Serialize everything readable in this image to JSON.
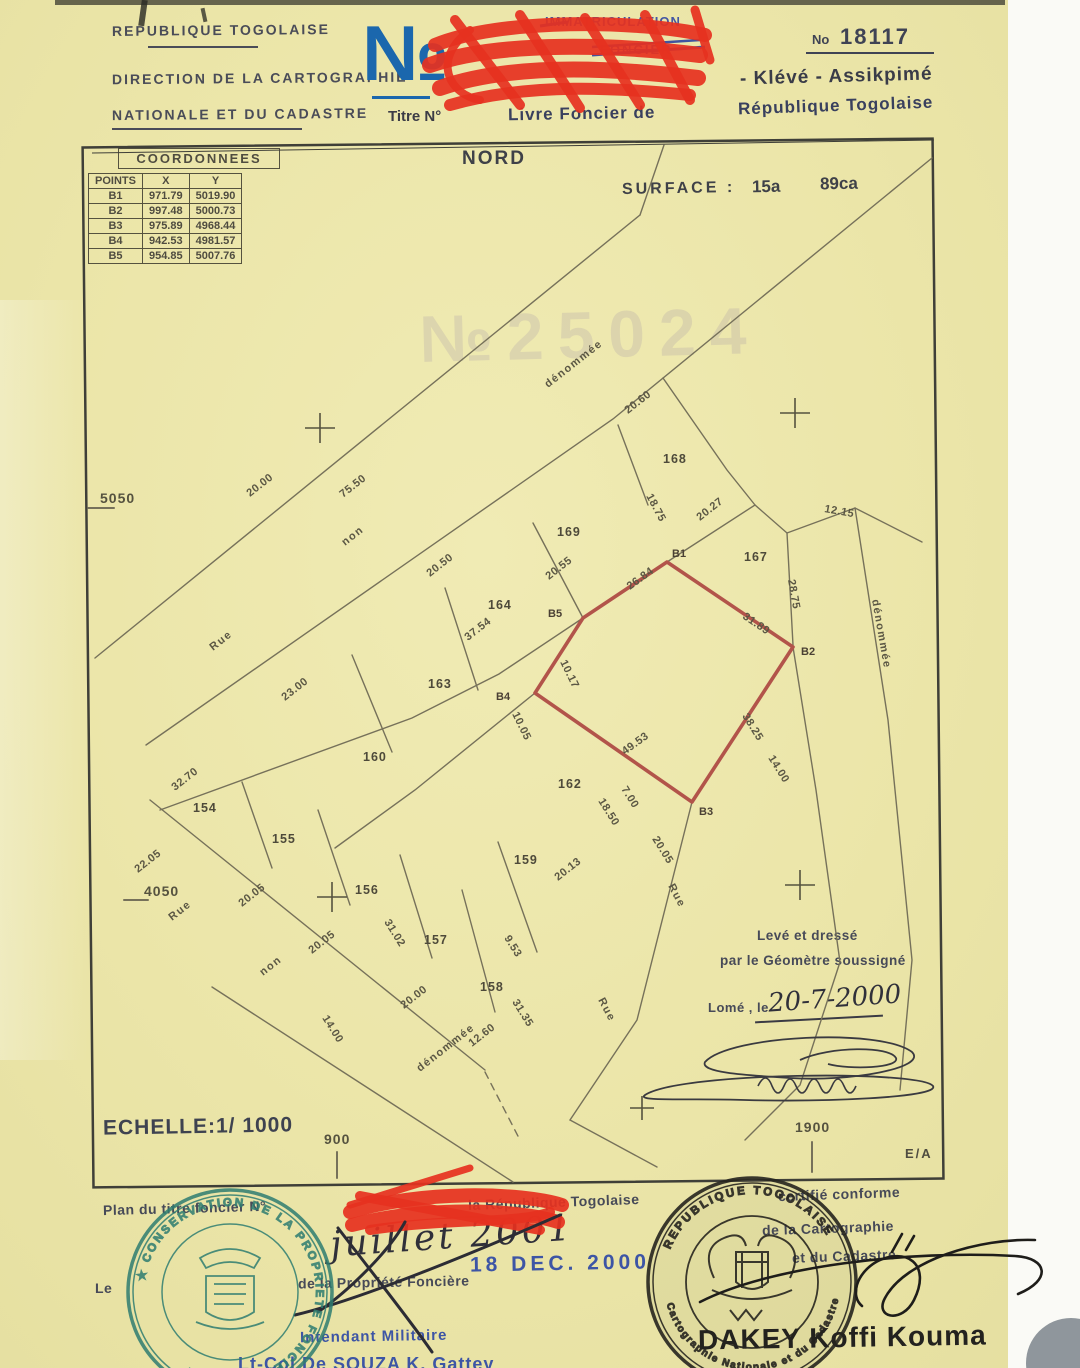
{
  "colors": {
    "paper": "#ece7ac",
    "map_line": "#6e6953",
    "parcel_red": "#b2544a",
    "scribble_red": "#e63120",
    "big_no_blue": "#1b67ad",
    "stamp_blue": "#4457a3",
    "stamp_teal": "#2f7d71",
    "stamp_black": "#23221f"
  },
  "header": {
    "country": "REPUBLIQUE TOGOLAISE",
    "dept1": "DIRECTION DE LA CARTOGRAPHIE",
    "dept2": "NATIONALE ET DU CADASTRE",
    "big_no": "№",
    "titre": "Titre N°",
    "immatriculation": "IMMATRICULATION",
    "foncier": "FONCIER",
    "reg_label": "No",
    "reg_number": "18117",
    "locality": "- Klévé - Assikpimé",
    "livre_left": "Livre Foncier de",
    "livre_right": "République Togolaise"
  },
  "table": {
    "title": "COORDONNEES",
    "columns": [
      "POINTS",
      "X",
      "Y"
    ],
    "rows": [
      [
        "B1",
        "971.79",
        "5019.90"
      ],
      [
        "B2",
        "997.48",
        "5000.73"
      ],
      [
        "B3",
        "975.89",
        "4968.44"
      ],
      [
        "B4",
        "942.53",
        "4981.57"
      ],
      [
        "B5",
        "954.85",
        "5007.76"
      ]
    ]
  },
  "map": {
    "north": "NORD",
    "surface_label": "SURFACE :",
    "surface_value_a": "15a",
    "surface_value_ca": "89ca",
    "watermark": "№25024",
    "scale": "ECHELLE:1/ 1000",
    "ea": "E/A",
    "grid_marks": [
      {
        "t": "5050",
        "x": 100,
        "y": 503
      },
      {
        "t": "4050",
        "x": 144,
        "y": 896
      }
    ],
    "axis_ticks": [
      {
        "t": "900",
        "x": 324,
        "y": 1144
      },
      {
        "t": "1900",
        "x": 795,
        "y": 1132
      }
    ],
    "parcels": [
      {
        "n": "154",
        "x": 193,
        "y": 812
      },
      {
        "n": "155",
        "x": 272,
        "y": 843
      },
      {
        "n": "156",
        "x": 355,
        "y": 894
      },
      {
        "n": "157",
        "x": 424,
        "y": 944
      },
      {
        "n": "158",
        "x": 480,
        "y": 991
      },
      {
        "n": "159",
        "x": 514,
        "y": 864
      },
      {
        "n": "160",
        "x": 363,
        "y": 761
      },
      {
        "n": "162",
        "x": 558,
        "y": 788
      },
      {
        "n": "163",
        "x": 428,
        "y": 688
      },
      {
        "n": "164",
        "x": 488,
        "y": 609
      },
      {
        "n": "167",
        "x": 744,
        "y": 561
      },
      {
        "n": "168",
        "x": 663,
        "y": 463
      },
      {
        "n": "169",
        "x": 557,
        "y": 536
      }
    ],
    "vertices": [
      {
        "n": "B1",
        "x": 672,
        "y": 557
      },
      {
        "n": "B2",
        "x": 801,
        "y": 655
      },
      {
        "n": "B3",
        "x": 699,
        "y": 815
      },
      {
        "n": "B4",
        "x": 496,
        "y": 700
      },
      {
        "n": "B5",
        "x": 548,
        "y": 617
      }
    ],
    "measurements": [
      {
        "t": "20.00",
        "x": 250,
        "y": 497,
        "r": -38
      },
      {
        "t": "75.50",
        "x": 343,
        "y": 498,
        "r": -38
      },
      {
        "t": "20.50",
        "x": 430,
        "y": 577,
        "r": -38
      },
      {
        "t": "20.55",
        "x": 549,
        "y": 580,
        "r": -38
      },
      {
        "t": "26.84",
        "x": 630,
        "y": 590,
        "r": -36
      },
      {
        "t": "31.89",
        "x": 742,
        "y": 618,
        "r": 34
      },
      {
        "t": "20.27",
        "x": 700,
        "y": 521,
        "r": -38
      },
      {
        "t": "18.75",
        "x": 646,
        "y": 496,
        "r": 62
      },
      {
        "t": "20.60",
        "x": 628,
        "y": 414,
        "r": -38
      },
      {
        "t": "12.15",
        "x": 824,
        "y": 512,
        "r": 10
      },
      {
        "t": "28.75",
        "x": 788,
        "y": 580,
        "r": 80
      },
      {
        "t": "38.25",
        "x": 742,
        "y": 716,
        "r": 58
      },
      {
        "t": "14.00",
        "x": 768,
        "y": 758,
        "r": 58
      },
      {
        "t": "49.53",
        "x": 625,
        "y": 755,
        "r": -36
      },
      {
        "t": "10.17",
        "x": 560,
        "y": 662,
        "r": 64
      },
      {
        "t": "10.05",
        "x": 512,
        "y": 714,
        "r": 64
      },
      {
        "t": "37.54",
        "x": 468,
        "y": 641,
        "r": -38
      },
      {
        "t": "23.00",
        "x": 285,
        "y": 701,
        "r": -38
      },
      {
        "t": "32.70",
        "x": 175,
        "y": 791,
        "r": -38
      },
      {
        "t": "22.05",
        "x": 138,
        "y": 873,
        "r": -38
      },
      {
        "t": "20.05",
        "x": 242,
        "y": 907,
        "r": -38
      },
      {
        "t": "20.05",
        "x": 312,
        "y": 954,
        "r": -38
      },
      {
        "t": "31.02",
        "x": 384,
        "y": 922,
        "r": 58
      },
      {
        "t": "20.00",
        "x": 404,
        "y": 1009,
        "r": -38
      },
      {
        "t": "14.00",
        "x": 322,
        "y": 1018,
        "r": 58
      },
      {
        "t": "12.60",
        "x": 472,
        "y": 1047,
        "r": -38
      },
      {
        "t": "31.35",
        "x": 512,
        "y": 1002,
        "r": 58
      },
      {
        "t": "9.53",
        "x": 504,
        "y": 938,
        "r": 58
      },
      {
        "t": "20.13",
        "x": 558,
        "y": 881,
        "r": -38
      },
      {
        "t": "18.50",
        "x": 598,
        "y": 801,
        "r": 58
      },
      {
        "t": "7.00",
        "x": 621,
        "y": 789,
        "r": 58
      },
      {
        "t": "20.05",
        "x": 652,
        "y": 839,
        "r": 58
      }
    ],
    "streets": [
      {
        "t": "Rue",
        "x": 213,
        "y": 651,
        "r": -38
      },
      {
        "t": "non",
        "x": 345,
        "y": 546,
        "r": -38
      },
      {
        "t": "dénommée",
        "x": 548,
        "y": 388,
        "r": -38
      },
      {
        "t": "Rue",
        "x": 172,
        "y": 921,
        "r": -38
      },
      {
        "t": "non",
        "x": 263,
        "y": 976,
        "r": -38
      },
      {
        "t": "dénommée",
        "x": 420,
        "y": 1072,
        "r": -38
      },
      {
        "t": "Rue",
        "x": 668,
        "y": 886,
        "r": 62
      },
      {
        "t": "dénommée",
        "x": 872,
        "y": 600,
        "r": 80
      },
      {
        "t": "Rue",
        "x": 598,
        "y": 1000,
        "r": 62
      }
    ]
  },
  "surveyor": {
    "line1": "Levé et dressé",
    "line2": "par le Géomètre soussigné",
    "place": "Lomé , le",
    "date": "20-7-2000"
  },
  "certification": {
    "plan_left": "Plan du titre foncier N°",
    "plan_right": "la République Togolaise",
    "conforme": "certifié conforme",
    "carto": "de la Cartographie",
    "cadastre": "et du Cadastre",
    "hand_date": "juillet 2001",
    "date_stamp": "18 DEC. 2000",
    "conservateur_left": "Le",
    "conservateur_right": "de la Propriété Foncière",
    "intendant": "Intendant Militaire",
    "officer": "Lt-Col De SOUZA K. Gattey",
    "signer": "DAKEY Koffi Kouma",
    "green_stamp": "★ CONSERVATION DE LA PROPRIETE FONCIERE ★ LOME",
    "black_stamp_top": "REPUBLIQUE TOGOLAISE",
    "black_stamp_bottom": "Cartographie Nationale et du Cadastre"
  }
}
